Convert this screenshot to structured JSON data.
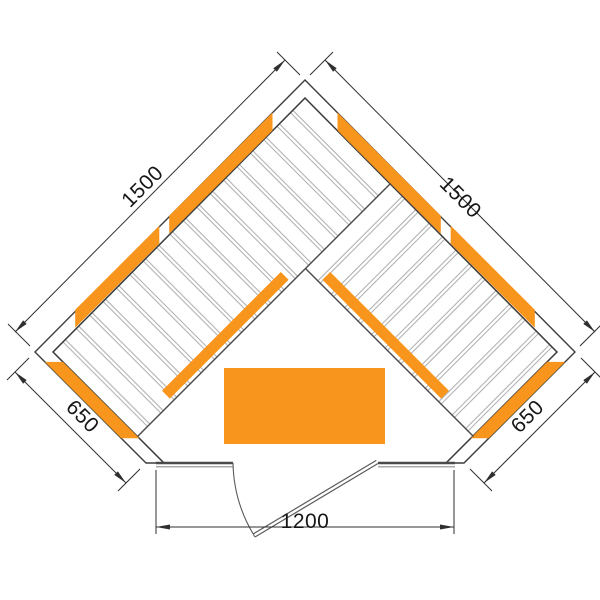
{
  "diagram": {
    "kind": "corner-sauna-floor-plan-top-view",
    "dimensions": {
      "left_wall": "1500",
      "right_wall": "1500",
      "lower_left_wall": "650",
      "lower_right_wall": "650",
      "front_wall": "1200"
    },
    "colors": {
      "heater_orange": "#F7951D",
      "wall_line": "#3d3d3d",
      "dimension_line": "#2f2f2f",
      "slat_gray": "#b4b4b4",
      "background": "#ffffff"
    }
  }
}
